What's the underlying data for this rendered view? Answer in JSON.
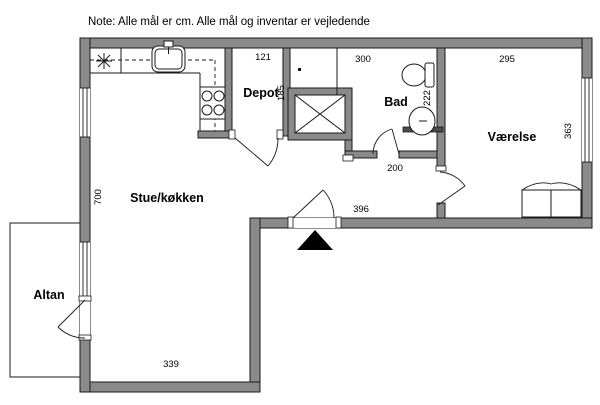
{
  "note": "Note: Alle mål er cm. Alle mål og inventar er vejledende",
  "rooms": {
    "living_kitchen": "Stue/køkken",
    "depot": "Depot",
    "bath": "Bad",
    "bedroom": "Værelse",
    "balcony": "Altan"
  },
  "dimensions": {
    "living_height_cm": "700",
    "living_width_cm": "339",
    "entry_wall_cm": "396",
    "hall_cm": "200",
    "depot_width_cm": "121",
    "depot_depth_cm": "185",
    "bath_width_cm": "300",
    "bath_depth_cm": "222",
    "bedroom_width_cm": "295",
    "bedroom_depth_cm": "363"
  },
  "fixtures": {
    "kitchen_sink": "kitchen-sink",
    "stove": "stove-four-burners",
    "appliance_symbol": "appliance-asterisk",
    "upper_cabinets": "dashed-cabinet-line",
    "shaft": "installation-shaft-crossed",
    "toilet": "toilet",
    "washbasin": "washbasin",
    "shower_screen": "shower-halfwall",
    "wardrobe": "wardrobe-double",
    "entrance_marker": "entrance-arrow"
  },
  "colors": {
    "wall": "#8a8a8a",
    "outline": "#1a1a1a",
    "background": "#ffffff",
    "entrance_marker": "#000000"
  }
}
